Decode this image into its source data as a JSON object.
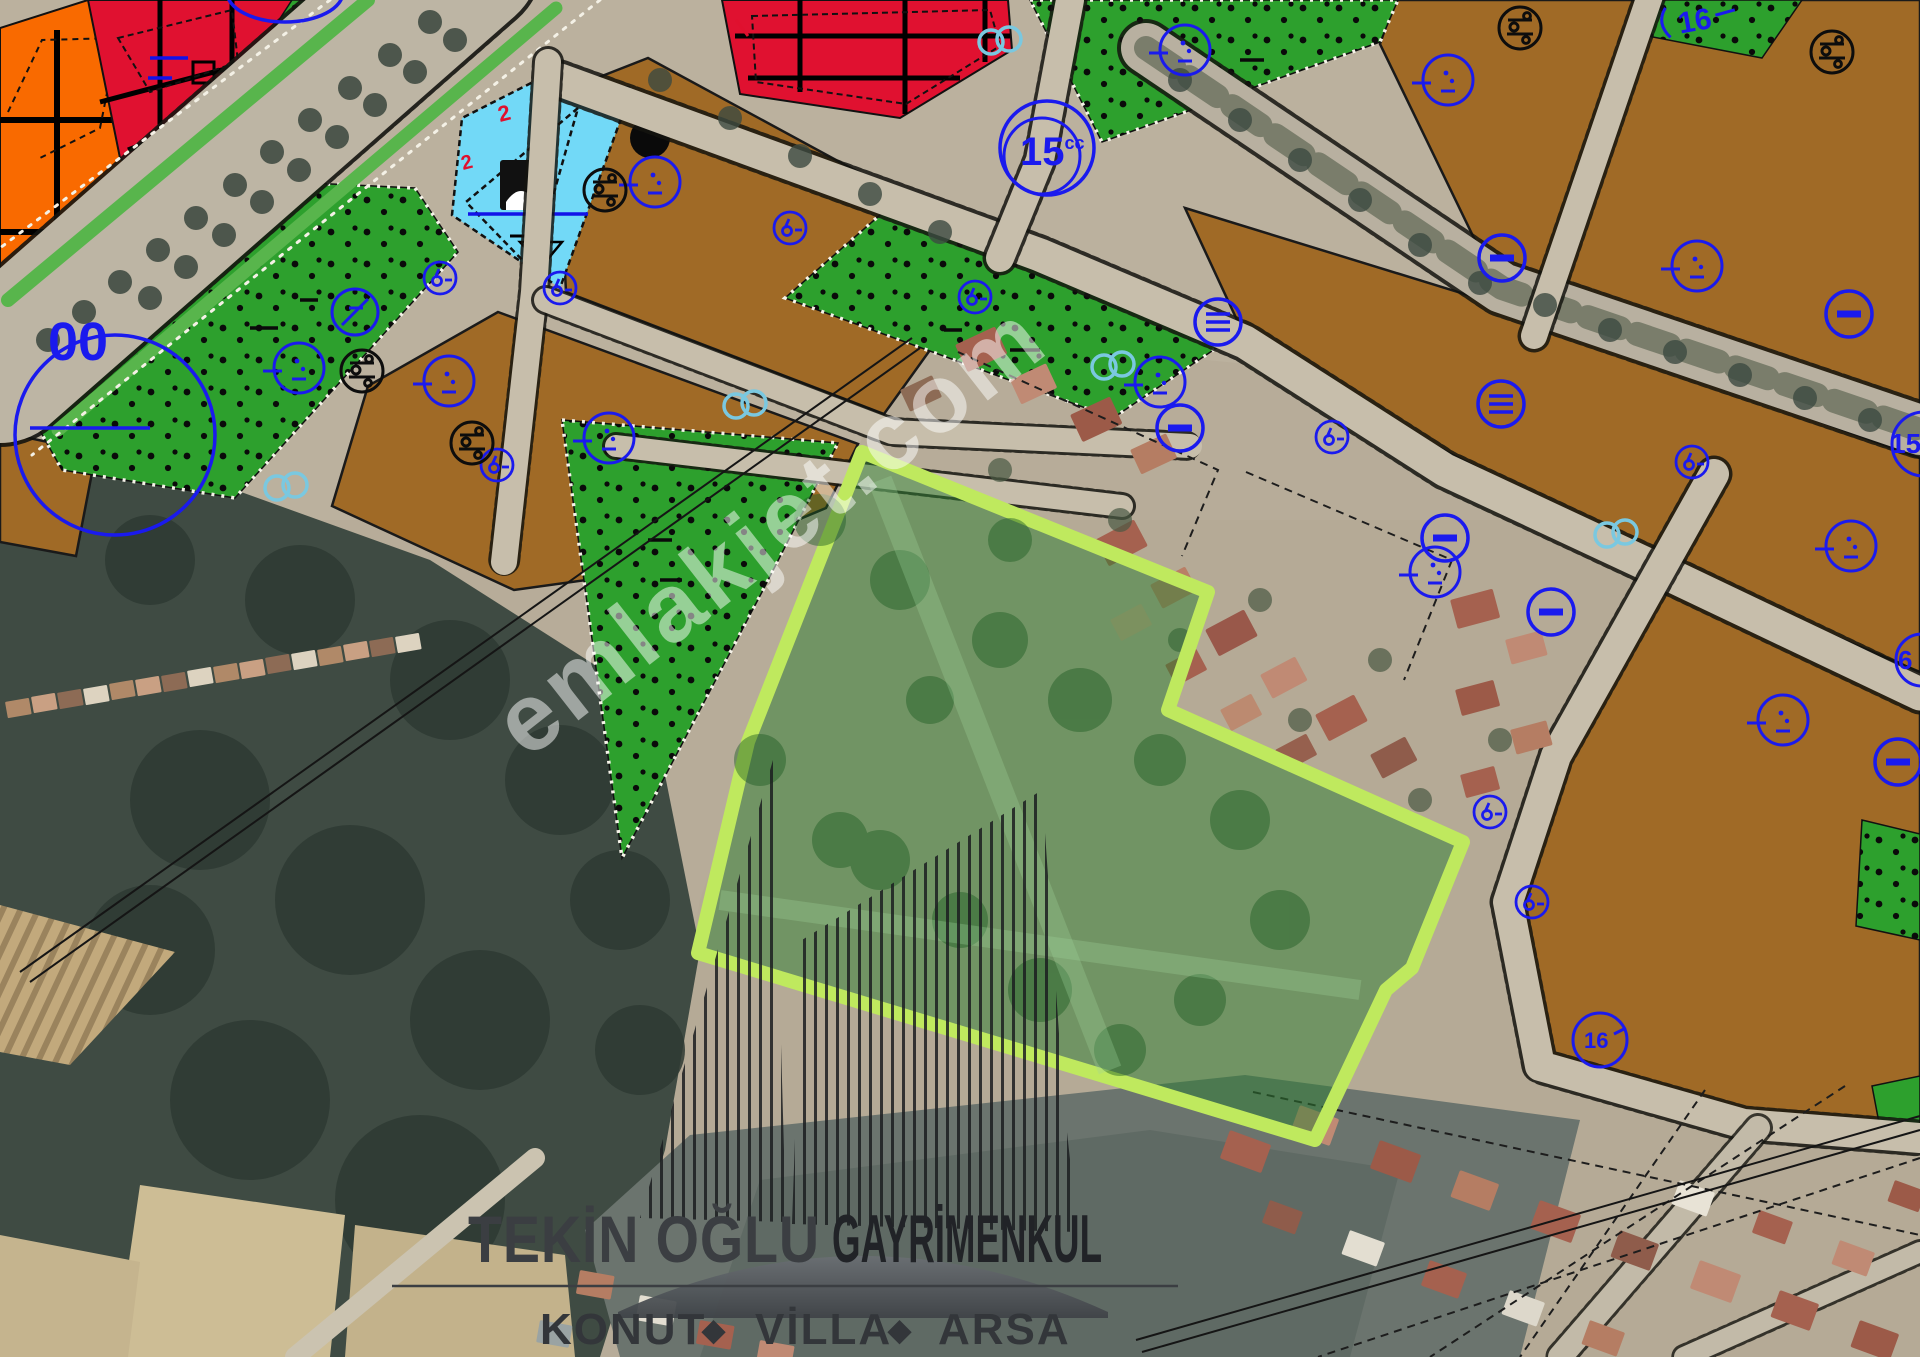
{
  "watermark": {
    "text": "emlakjet.com"
  },
  "logo": {
    "brand_light": "TEKİN OĞLU",
    "brand_bold": "GAYRİMENKUL",
    "tagline": {
      "item1": "KONUT",
      "sep1": "◆",
      "item2": "VİLLA",
      "sep2": "◆",
      "item3": "ARSA"
    }
  },
  "map_labels": {
    "left_circle": "00",
    "junction_circle": "15",
    "junction_circle_sup": "cc",
    "top_right": "16",
    "right_edge_upper": "15",
    "right_edge_lower": "6",
    "bottom_right_circle": "16",
    "red_mark_a": "2",
    "red_mark_b": "2"
  },
  "legend_colors": {
    "residential_brown": "#a06a26",
    "park_green": "#2da02d",
    "commercial_red": "#e01130",
    "mixed_use_orange": "#f96a00",
    "facility_cyan": "#72d9f7",
    "parcel_outline_lime": "#bfe95e",
    "plan_symbol_blue": "#1a1aee"
  }
}
